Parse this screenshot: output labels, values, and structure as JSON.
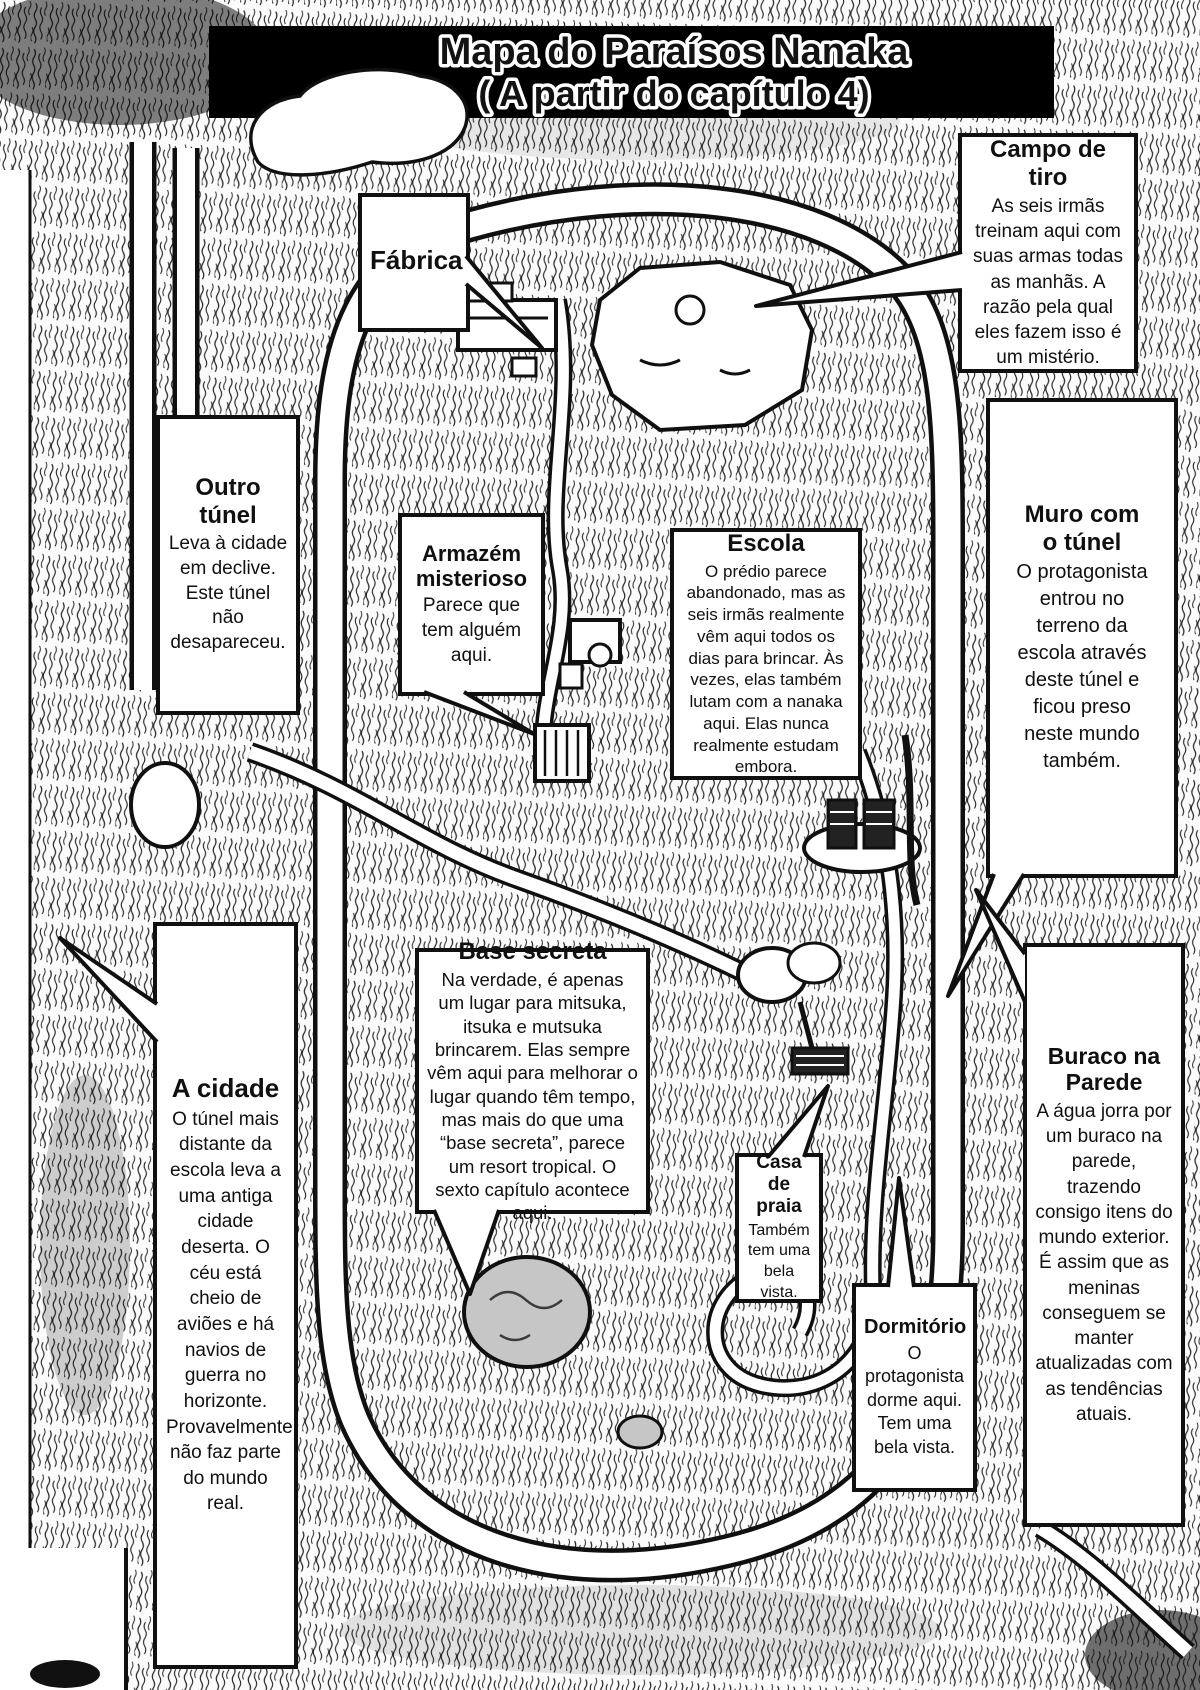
{
  "page": {
    "title_line1": "Mapa do Paraísos Nanaka",
    "title_line2": "( A partir do capítulo 4)"
  },
  "colors": {
    "ink": "#101010",
    "paper": "#ffffff",
    "banner": "#000000"
  },
  "callouts": [
    {
      "id": "fabrica",
      "title": "Fábrica",
      "body": ""
    },
    {
      "id": "campo-de-tiro",
      "title": "Campo de tiro",
      "body": "As seis irmãs treinam aqui com suas armas todas as manhãs. A razão pela qual eles fazem isso é um mistério."
    },
    {
      "id": "outro-tunel",
      "title": "Outro túnel",
      "body": "Leva à cidade em declive. Este túnel não desapareceu."
    },
    {
      "id": "armazem-misterioso",
      "title": "Armazém misterioso",
      "body": "Parece que tem alguém aqui."
    },
    {
      "id": "escola",
      "title": "Escola",
      "body": "O prédio parece abandonado, mas as seis irmãs realmente vêm aqui todos os dias para brincar. Às vezes, elas também lutam com a nanaka aqui. Elas nunca realmente estudam embora."
    },
    {
      "id": "muro-com-o-tunel",
      "title": "Muro com o túnel",
      "body": "O protagonista entrou no terreno da escola através deste túnel e ficou preso neste mundo também."
    },
    {
      "id": "a-cidade",
      "title": "A cidade",
      "body": "O túnel mais distante da escola leva a uma antiga cidade deserta. O céu está cheio de aviões e há navios de guerra no horizonte. Provavelmente não faz parte do mundo real."
    },
    {
      "id": "base-secreta",
      "title": "Base secreta",
      "body": "Na verdade, é apenas um lugar para mitsuka, itsuka e mutsuka brincarem. Elas sempre vêm aqui para melhorar o lugar quando têm tempo, mas mais do que uma “base secreta”, parece um resort tropical. O sexto capítulo acontece aqui."
    },
    {
      "id": "casa-de-praia",
      "title": "Casa de praia",
      "body": "Também tem uma bela vista."
    },
    {
      "id": "buraco-na-parede",
      "title": "Buraco na Parede",
      "body": "A água jorra por um buraco na parede, trazendo consigo itens do mundo exterior. É assim que as meninas conseguem se manter atualizadas com as tendências atuais."
    },
    {
      "id": "dormitorio",
      "title": "Dormitório",
      "body": "O protagonista dorme aqui. Tem uma bela vista."
    }
  ]
}
